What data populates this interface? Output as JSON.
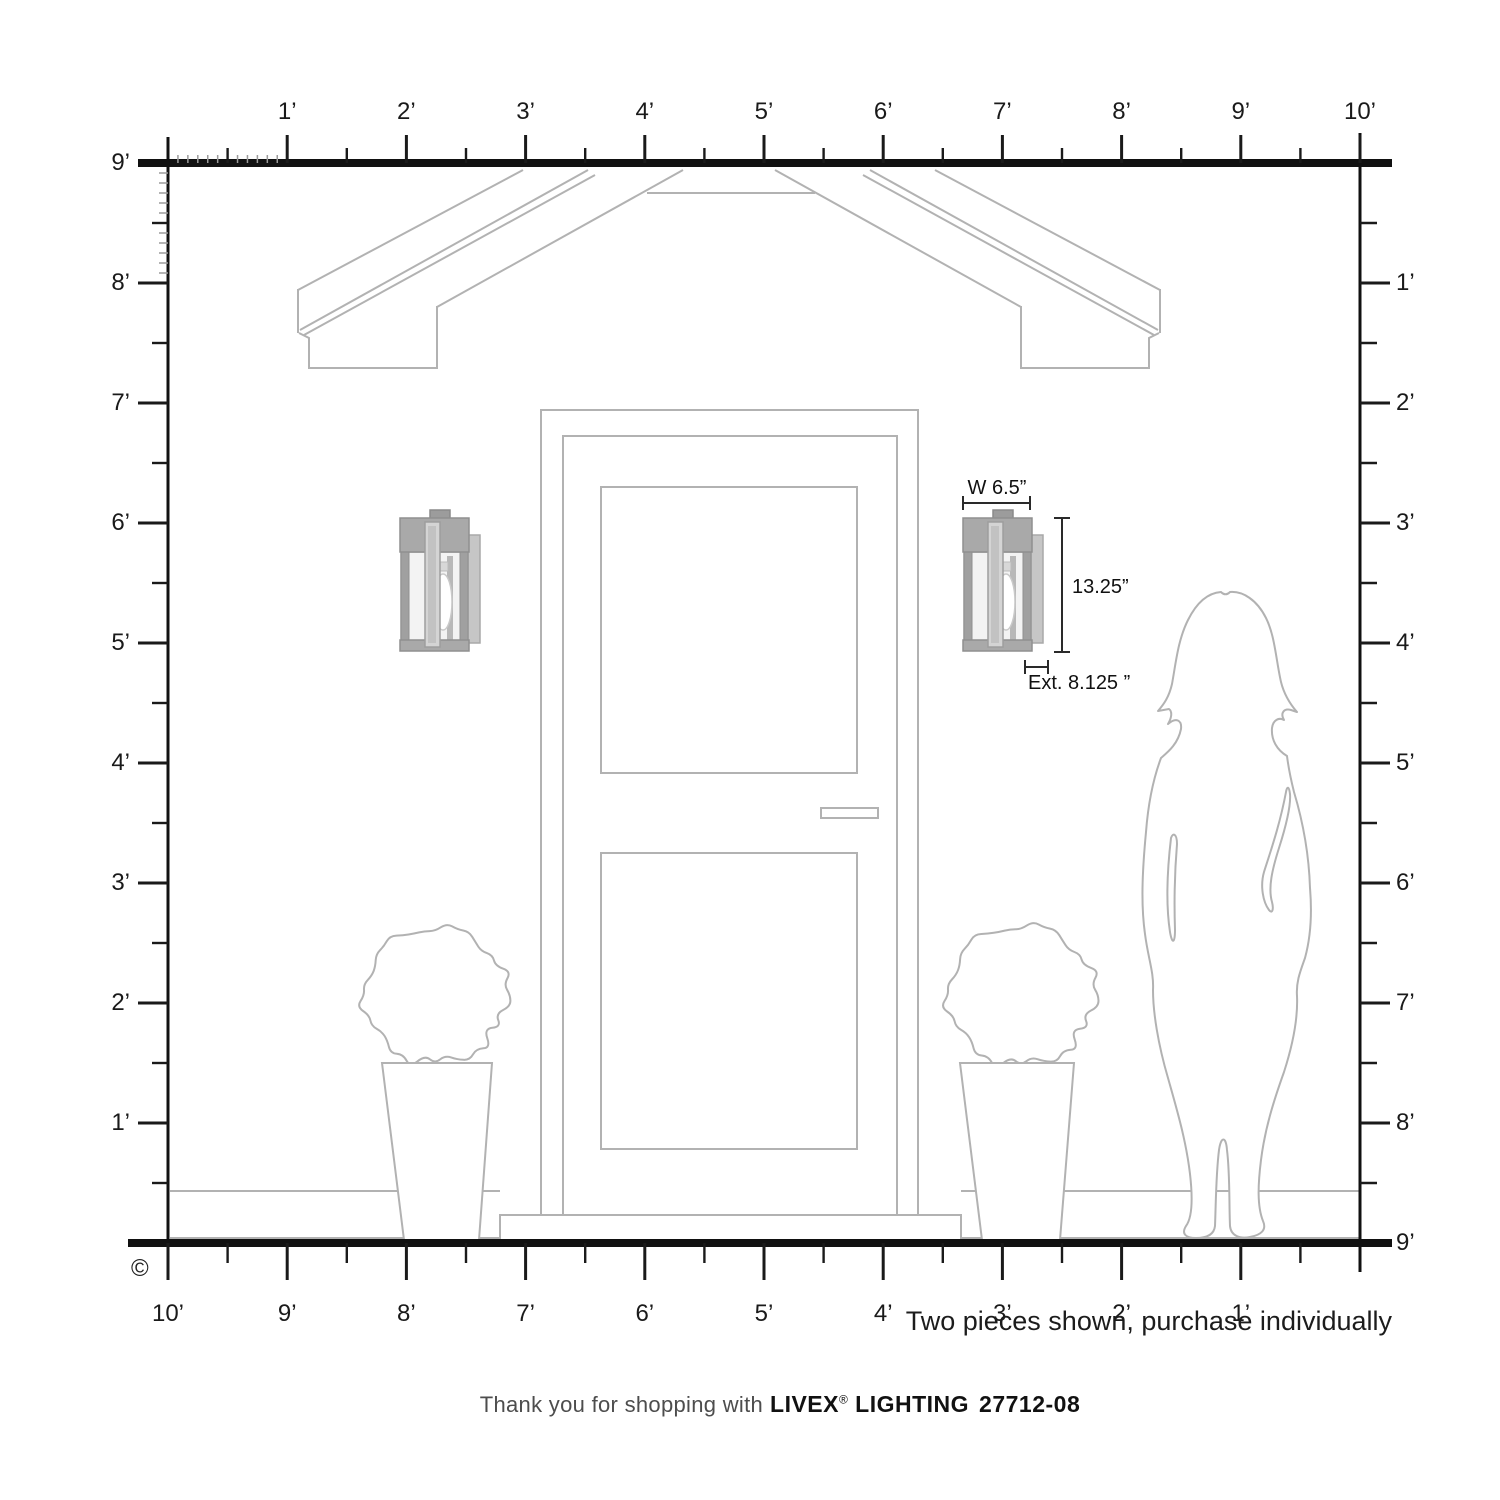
{
  "rulers": {
    "top_labels": [
      "1’",
      "2’",
      "3’",
      "4’",
      "5’",
      "6’",
      "7’",
      "8’",
      "9’",
      "10’"
    ],
    "left_labels": [
      "9’",
      "8’",
      "7’",
      "6’",
      "5’",
      "4’",
      "3’",
      "2’",
      "1’"
    ],
    "right_labels": [
      "1’",
      "2’",
      "3’",
      "4’",
      "5’",
      "6’",
      "7’",
      "8’",
      "9’"
    ],
    "bottom_labels": [
      "10’",
      "9’",
      "8’",
      "7’",
      "6’",
      "5’",
      "4’",
      "3’",
      "2’",
      "1’"
    ]
  },
  "dimensions": {
    "width": "W 6.5”",
    "height": "13.25”",
    "extension": "Ext. 8.125 ”"
  },
  "footer": {
    "note": "Two pieces shown, purchase individually",
    "thanks_prefix": "Thank you for shopping with",
    "brand": "LIVEX",
    "registered_mark": "®",
    "brand_suffix": "LIGHTING",
    "model": "27712-08",
    "copyright_symbol": "©"
  },
  "colors": {
    "ruler_ink": "#1a1a1a",
    "sketch_gray": "#b2b2b2",
    "fixture_gray": "#a9a9a9",
    "fixture_light": "#f3f3f3"
  }
}
